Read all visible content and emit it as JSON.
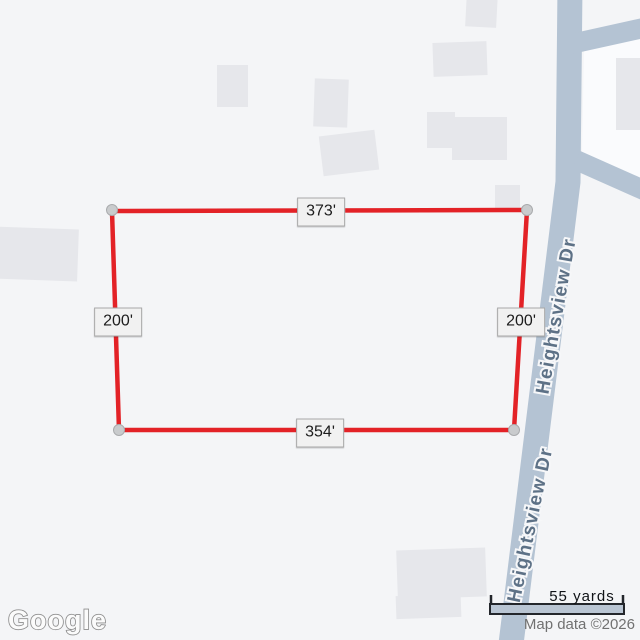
{
  "map": {
    "background_color": "#f4f5f7",
    "road_color": "#b4c3d3",
    "road_block_color": "#fafbfd",
    "building_color": "#e6e7eb"
  },
  "parcel": {
    "outline_color": "#e32227",
    "corner_marker_color": "#c9cbcd",
    "dimensions": {
      "top": "373'",
      "right": "200'",
      "bottom": "354'",
      "left": "200'"
    }
  },
  "roads": {
    "name": "Heightsview Dr"
  },
  "scale_bar": {
    "label": "55 yards"
  },
  "attribution": {
    "logo": "Google",
    "text": "Map data ©2026"
  }
}
